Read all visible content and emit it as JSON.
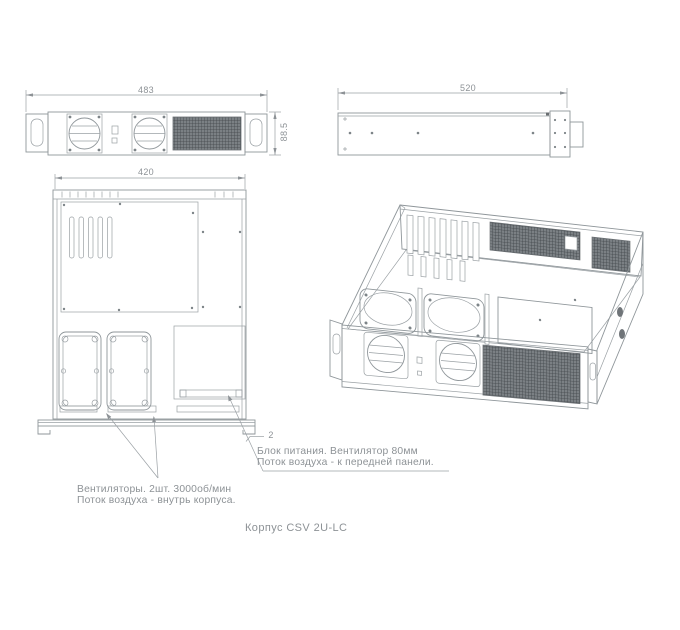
{
  "drawing": {
    "caption": "Корпус CSV 2U-LC",
    "front_view": {
      "width_mm": "483",
      "height_mm": "88.5"
    },
    "side_view": {
      "length_mm": "520"
    },
    "top_view": {
      "width_mm": "420",
      "flange_thickness_mm": "2"
    },
    "callouts": {
      "psu": {
        "line1": "Блок питания. Вентилятор 80мм",
        "line2": "Поток воздуха - к передней панели."
      },
      "front_fans": {
        "line1": "Вентиляторы. 2шт. 3000об/мин",
        "line2": "Поток воздуха - внутрь корпуса."
      }
    },
    "colors": {
      "line": "#8f969a",
      "mesh_dark": "#54595c",
      "text": "#8d9296",
      "background": "#ffffff"
    }
  }
}
